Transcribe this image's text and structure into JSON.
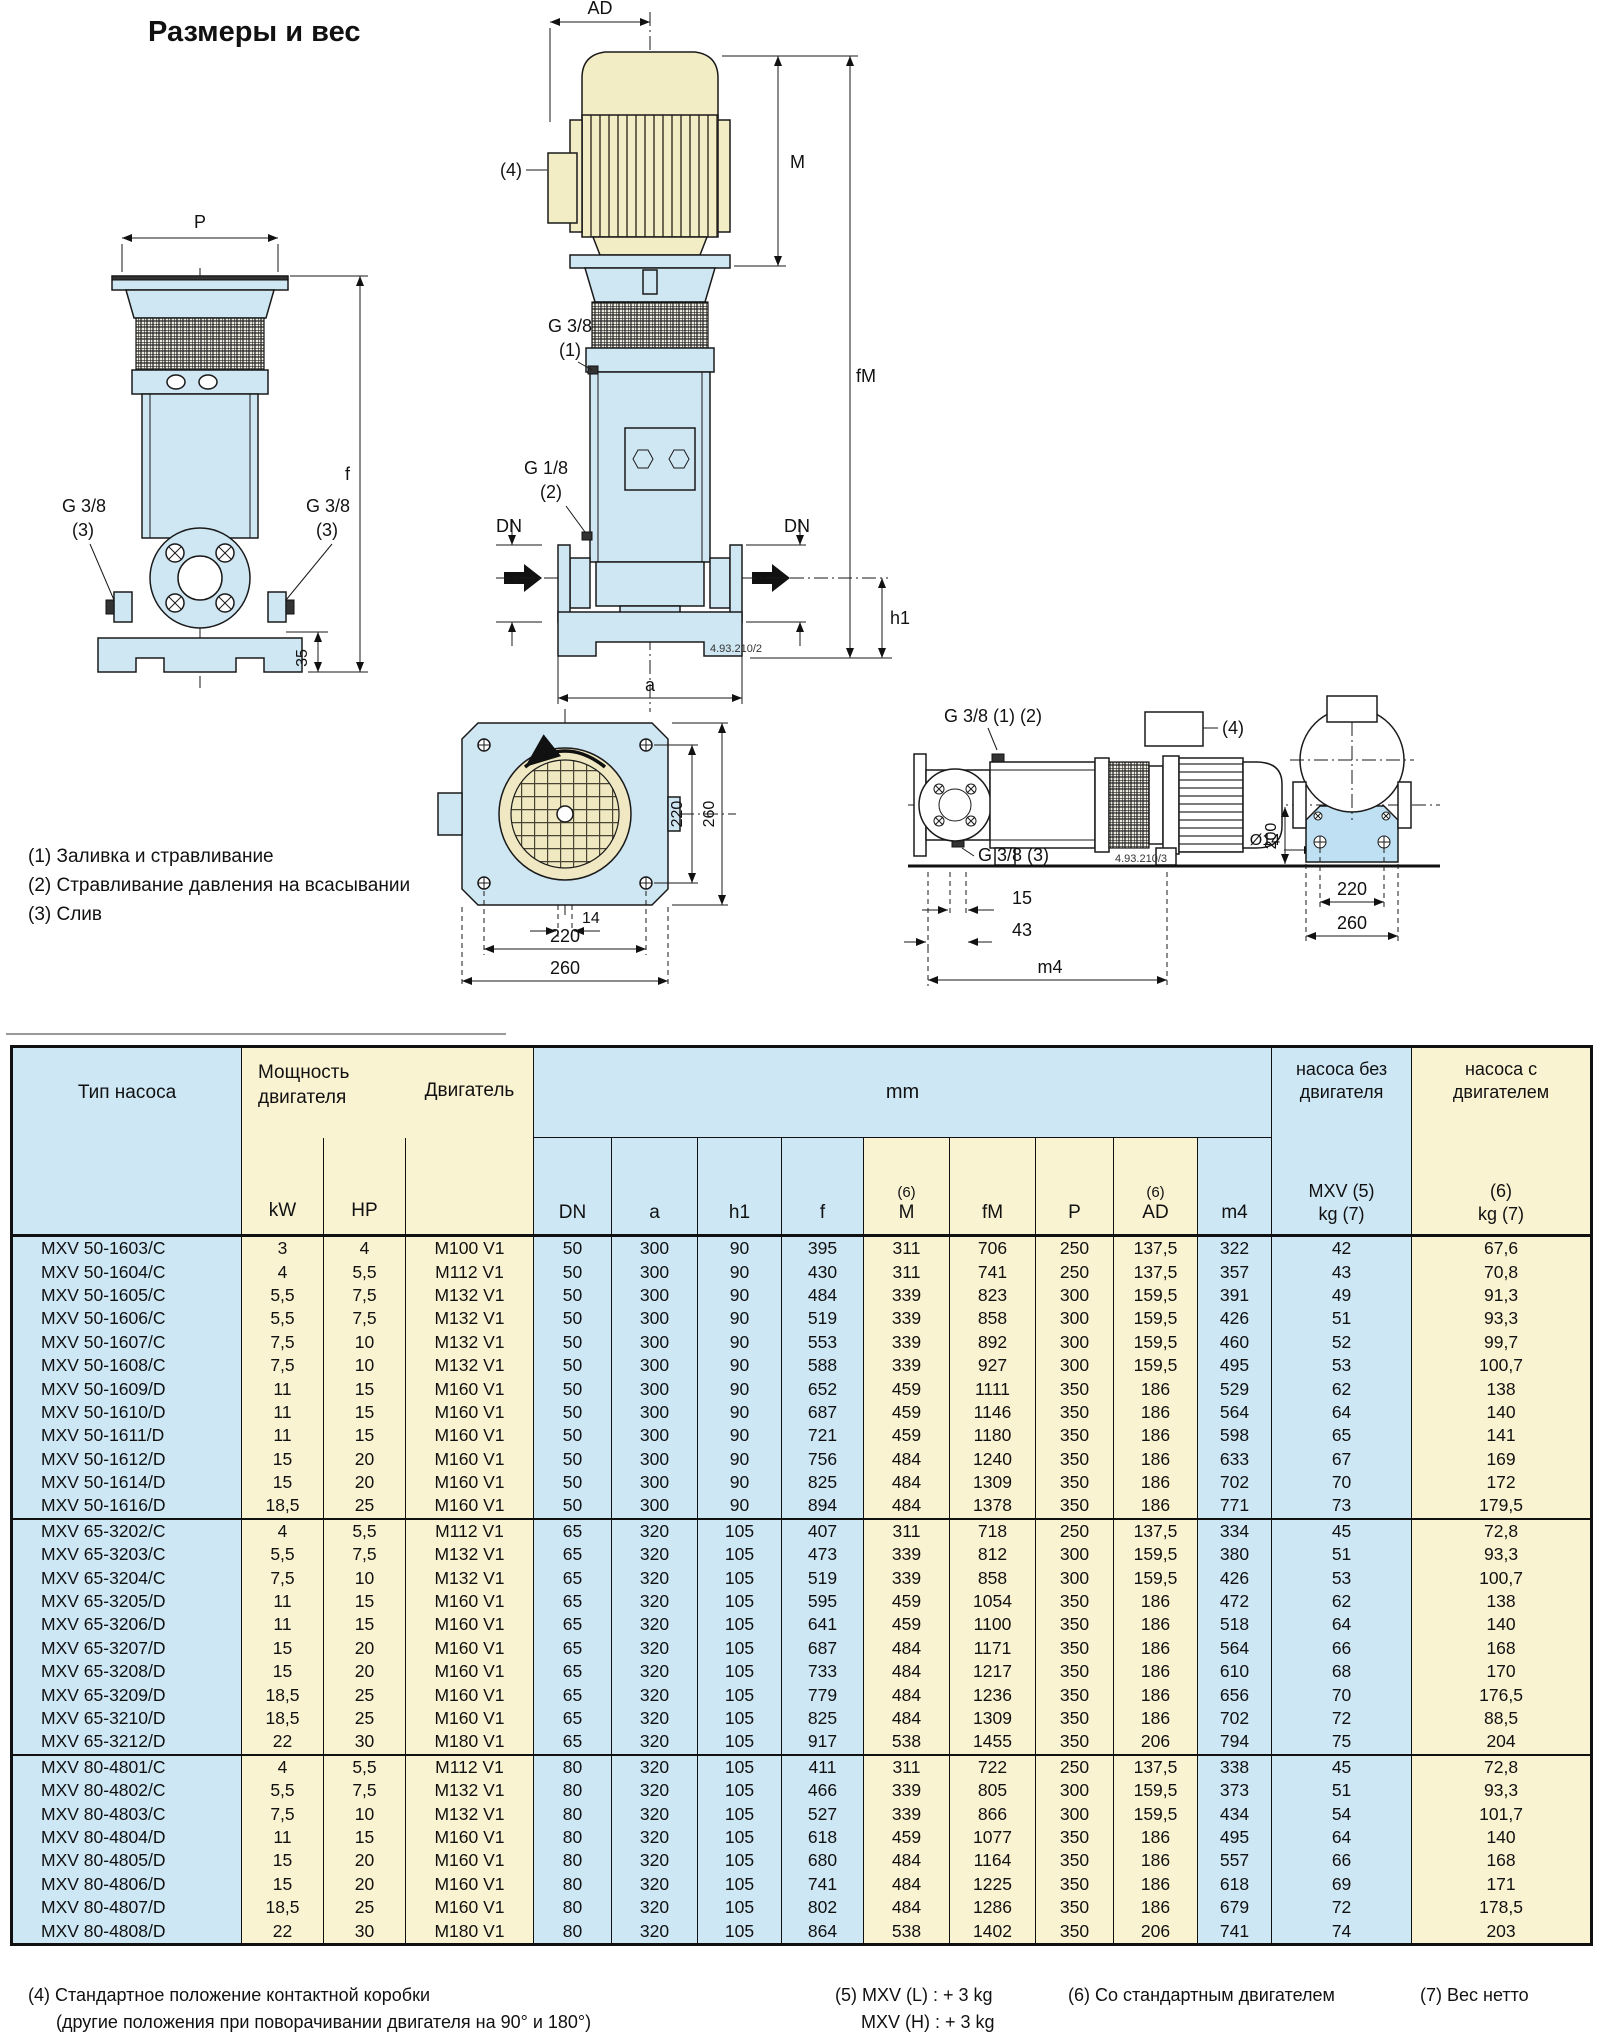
{
  "page": {
    "title": "Размеры и вес"
  },
  "legend": {
    "items": [
      "(1) Заливка и стравливание",
      "(2) Стравливание давления на всасывании",
      "(3) Слив"
    ]
  },
  "drawings": {
    "front_view": {
      "p": "P",
      "f": "f",
      "n35": "35",
      "g38": "G 3/8",
      "n3": "(3)"
    },
    "side_view": {
      "ad": "AD",
      "m": "M",
      "fm": "fM",
      "n4": "(4)",
      "g38": "G 3/8",
      "n1": "(1)",
      "g18": "G 1/8",
      "n2": "(2)",
      "dn": "DN",
      "h1": "h1",
      "a": "a",
      "code": "4.93.210/2"
    },
    "top_view": {
      "n220": "220",
      "n260": "260",
      "n14": "14"
    },
    "horizontal_view": {
      "g38_12": "G 3/8 (1) (2)",
      "n4": "(4)",
      "g38_3": "G 3/8 (3)",
      "code": "4.93.210/3",
      "n200": "200",
      "d14": "Ø14",
      "n15": "15",
      "n43": "43",
      "m4": "m4",
      "n220": "220",
      "n260": "260"
    }
  },
  "table": {
    "header": {
      "type": "Тип насоса",
      "power1": "Мощность",
      "power2": "двигателя",
      "motor": "Двигатель",
      "mm": "mm",
      "kw": "kW",
      "hp": "HP",
      "dn": "DN",
      "a": "a",
      "h1": "h1",
      "f": "f",
      "m": "M",
      "fm": "fM",
      "p": "P",
      "ad": "AD",
      "m4": "m4",
      "sup6": "(6)",
      "wo1": "насоса без",
      "wo2": "двигателя",
      "wo3": "MXV (5)",
      "wo4": "kg (7)",
      "w1": "насоса с",
      "w2": "двигателем",
      "w3": "(6)",
      "w4": "kg (7)"
    },
    "groups": [
      {
        "rows": [
          [
            "MXV 50-1603/C",
            "3",
            "4",
            "M100 V1",
            "50",
            "300",
            "90",
            "395",
            "311",
            "706",
            "250",
            "137,5",
            "322",
            "42",
            "67,6"
          ],
          [
            "MXV 50-1604/C",
            "4",
            "5,5",
            "M112 V1",
            "50",
            "300",
            "90",
            "430",
            "311",
            "741",
            "250",
            "137,5",
            "357",
            "43",
            "70,8"
          ],
          [
            "MXV 50-1605/C",
            "5,5",
            "7,5",
            "M132 V1",
            "50",
            "300",
            "90",
            "484",
            "339",
            "823",
            "300",
            "159,5",
            "391",
            "49",
            "91,3"
          ],
          [
            "MXV 50-1606/C",
            "5,5",
            "7,5",
            "M132 V1",
            "50",
            "300",
            "90",
            "519",
            "339",
            "858",
            "300",
            "159,5",
            "426",
            "51",
            "93,3"
          ],
          [
            "MXV 50-1607/C",
            "7,5",
            "10",
            "M132 V1",
            "50",
            "300",
            "90",
            "553",
            "339",
            "892",
            "300",
            "159,5",
            "460",
            "52",
            "99,7"
          ],
          [
            "MXV 50-1608/C",
            "7,5",
            "10",
            "M132 V1",
            "50",
            "300",
            "90",
            "588",
            "339",
            "927",
            "300",
            "159,5",
            "495",
            "53",
            "100,7"
          ],
          [
            "MXV 50-1609/D",
            "11",
            "15",
            "M160 V1",
            "50",
            "300",
            "90",
            "652",
            "459",
            "1111",
            "350",
            "186",
            "529",
            "62",
            "138"
          ],
          [
            "MXV 50-1610/D",
            "11",
            "15",
            "M160 V1",
            "50",
            "300",
            "90",
            "687",
            "459",
            "1146",
            "350",
            "186",
            "564",
            "64",
            "140"
          ],
          [
            "MXV 50-1611/D",
            "11",
            "15",
            "M160 V1",
            "50",
            "300",
            "90",
            "721",
            "459",
            "1180",
            "350",
            "186",
            "598",
            "65",
            "141"
          ],
          [
            "MXV 50-1612/D",
            "15",
            "20",
            "M160 V1",
            "50",
            "300",
            "90",
            "756",
            "484",
            "1240",
            "350",
            "186",
            "633",
            "67",
            "169"
          ],
          [
            "MXV 50-1614/D",
            "15",
            "20",
            "M160 V1",
            "50",
            "300",
            "90",
            "825",
            "484",
            "1309",
            "350",
            "186",
            "702",
            "70",
            "172"
          ],
          [
            "MXV 50-1616/D",
            "18,5",
            "25",
            "M160 V1",
            "50",
            "300",
            "90",
            "894",
            "484",
            "1378",
            "350",
            "186",
            "771",
            "73",
            "179,5"
          ]
        ]
      },
      {
        "rows": [
          [
            "MXV 65-3202/C",
            "4",
            "5,5",
            "M112 V1",
            "65",
            "320",
            "105",
            "407",
            "311",
            "718",
            "250",
            "137,5",
            "334",
            "45",
            "72,8"
          ],
          [
            "MXV 65-3203/C",
            "5,5",
            "7,5",
            "M132 V1",
            "65",
            "320",
            "105",
            "473",
            "339",
            "812",
            "300",
            "159,5",
            "380",
            "51",
            "93,3"
          ],
          [
            "MXV 65-3204/C",
            "7,5",
            "10",
            "M132 V1",
            "65",
            "320",
            "105",
            "519",
            "339",
            "858",
            "300",
            "159,5",
            "426",
            "53",
            "100,7"
          ],
          [
            "MXV 65-3205/D",
            "11",
            "15",
            "M160 V1",
            "65",
            "320",
            "105",
            "595",
            "459",
            "1054",
            "350",
            "186",
            "472",
            "62",
            "138"
          ],
          [
            "MXV 65-3206/D",
            "11",
            "15",
            "M160 V1",
            "65",
            "320",
            "105",
            "641",
            "459",
            "1100",
            "350",
            "186",
            "518",
            "64",
            "140"
          ],
          [
            "MXV 65-3207/D",
            "15",
            "20",
            "M160 V1",
            "65",
            "320",
            "105",
            "687",
            "484",
            "1171",
            "350",
            "186",
            "564",
            "66",
            "168"
          ],
          [
            "MXV 65-3208/D",
            "15",
            "20",
            "M160 V1",
            "65",
            "320",
            "105",
            "733",
            "484",
            "1217",
            "350",
            "186",
            "610",
            "68",
            "170"
          ],
          [
            "MXV 65-3209/D",
            "18,5",
            "25",
            "M160 V1",
            "65",
            "320",
            "105",
            "779",
            "484",
            "1236",
            "350",
            "186",
            "656",
            "70",
            "176,5"
          ],
          [
            "MXV 65-3210/D",
            "18,5",
            "25",
            "M160 V1",
            "65",
            "320",
            "105",
            "825",
            "484",
            "1309",
            "350",
            "186",
            "702",
            "72",
            "88,5"
          ],
          [
            "MXV 65-3212/D",
            "22",
            "30",
            "M180 V1",
            "65",
            "320",
            "105",
            "917",
            "538",
            "1455",
            "350",
            "206",
            "794",
            "75",
            "204"
          ]
        ]
      },
      {
        "rows": [
          [
            "MXV 80-4801/C",
            "4",
            "5,5",
            "M112 V1",
            "80",
            "320",
            "105",
            "411",
            "311",
            "722",
            "250",
            "137,5",
            "338",
            "45",
            "72,8"
          ],
          [
            "MXV 80-4802/C",
            "5,5",
            "7,5",
            "M132 V1",
            "80",
            "320",
            "105",
            "466",
            "339",
            "805",
            "300",
            "159,5",
            "373",
            "51",
            "93,3"
          ],
          [
            "MXV 80-4803/C",
            "7,5",
            "10",
            "M132 V1",
            "80",
            "320",
            "105",
            "527",
            "339",
            "866",
            "300",
            "159,5",
            "434",
            "54",
            "101,7"
          ],
          [
            "MXV 80-4804/D",
            "11",
            "15",
            "M160 V1",
            "80",
            "320",
            "105",
            "618",
            "459",
            "1077",
            "350",
            "186",
            "495",
            "64",
            "140"
          ],
          [
            "MXV 80-4805/D",
            "15",
            "20",
            "M160 V1",
            "80",
            "320",
            "105",
            "680",
            "484",
            "1164",
            "350",
            "186",
            "557",
            "66",
            "168"
          ],
          [
            "MXV 80-4806/D",
            "15",
            "20",
            "M160 V1",
            "80",
            "320",
            "105",
            "741",
            "484",
            "1225",
            "350",
            "186",
            "618",
            "69",
            "171"
          ],
          [
            "MXV 80-4807/D",
            "18,5",
            "25",
            "M160 V1",
            "80",
            "320",
            "105",
            "802",
            "484",
            "1286",
            "350",
            "186",
            "679",
            "72",
            "178,5"
          ],
          [
            "MXV 80-4808/D",
            "22",
            "30",
            "M180 V1",
            "80",
            "320",
            "105",
            "864",
            "538",
            "1402",
            "350",
            "206",
            "741",
            "74",
            "203"
          ]
        ]
      }
    ]
  },
  "footnotes": {
    "n4a": "(4) Стандартное положение контактной коробки",
    "n4b": "(другие положения при поворачивании двигателя на 90° и 180°)",
    "n5a": "(5) MXV (L) : + 3 kg",
    "n5b": "MXV (H) : + 3 kg",
    "n6": "(6) Со стандартным двигателем",
    "n7": "(7) Вес нетто"
  }
}
